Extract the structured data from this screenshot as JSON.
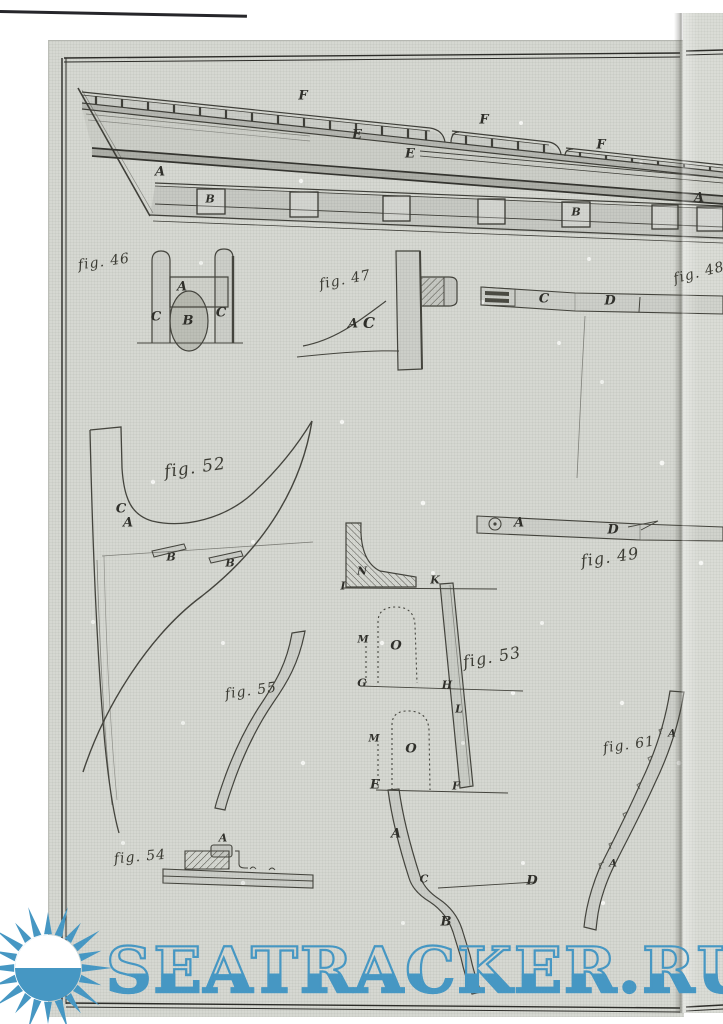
{
  "watermark": {
    "text": "SEATRACKER.RU",
    "color": "#4697c3",
    "icon": "sunburst-sun-icon"
  },
  "plate": {
    "paper_color": "#d6d8d2",
    "ship": {
      "labels": {
        "f1": "F",
        "f2": "F",
        "f3": "F",
        "e1": "E",
        "e2": "E",
        "a1": "A",
        "a2": "A",
        "b1": "B",
        "b2": "B"
      }
    },
    "figures": {
      "fig46": {
        "caption": "fig. 46",
        "labels": {
          "a": "A",
          "b": "B",
          "c1": "C",
          "c2": "C"
        }
      },
      "fig47": {
        "caption": "fig. 47",
        "labels": {
          "a": "A",
          "c": "C"
        }
      },
      "fig48": {
        "caption": "fig. 48",
        "labels": {
          "c": "C",
          "d": "D"
        }
      },
      "fig49": {
        "caption": "fig. 49",
        "labels": {
          "a": "A",
          "d": "D"
        }
      },
      "fig52": {
        "caption": "fig. 52",
        "labels": {
          "c": "C",
          "a": "A",
          "b1": "B",
          "b2": "B"
        }
      },
      "fig53": {
        "caption": "fig. 53",
        "labels": {
          "n": "N",
          "i": "I",
          "k": "K",
          "m1": "M",
          "o1": "O",
          "g": "G",
          "h": "H",
          "l": "L",
          "m2": "M",
          "o2": "O",
          "e": "E",
          "f": "F",
          "a": "A",
          "c": "C",
          "d": "D",
          "b": "B"
        }
      },
      "fig54": {
        "caption": "fig. 54",
        "labels": {
          "a": "A"
        }
      },
      "fig55": {
        "caption": "fig. 55"
      },
      "fig61": {
        "caption": "fig. 61",
        "labels": {
          "a1": "A",
          "a2": "A"
        }
      }
    }
  }
}
